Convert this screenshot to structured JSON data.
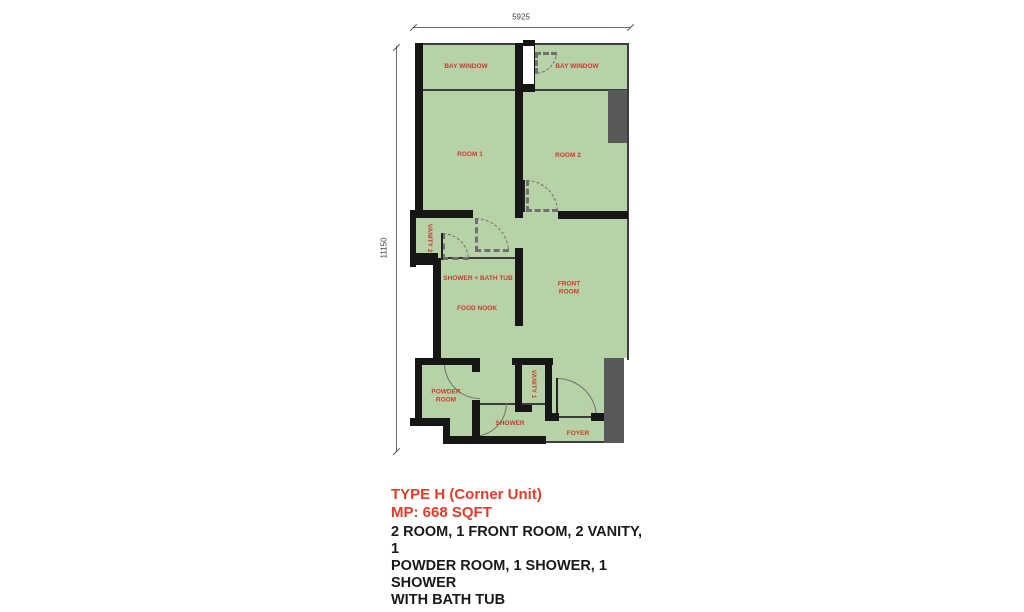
{
  "plan": {
    "dimensions": {
      "width_label": "5925",
      "height_label": "11150"
    },
    "rooms": [
      {
        "name": "bay-window-left",
        "label": "BAY WINDOW"
      },
      {
        "name": "bay-window-right",
        "label": "BAY WINDOW"
      },
      {
        "name": "room-1",
        "label": "ROOM 1"
      },
      {
        "name": "room-2",
        "label": "ROOM 2"
      },
      {
        "name": "vanity-2",
        "label": "VANITY 2"
      },
      {
        "name": "shower-bath-tub",
        "label": "SHOWER + BATH TUB"
      },
      {
        "name": "food-nook",
        "label": "FOOD NOOK"
      },
      {
        "name": "front-room",
        "label": "FRONT ROOM"
      },
      {
        "name": "powder-room",
        "label": "POWDER ROOM"
      },
      {
        "name": "vanity-1",
        "label": "VANITY 1"
      },
      {
        "name": "shower",
        "label": "SHOWER"
      },
      {
        "name": "foyer",
        "label": "FOYER"
      }
    ]
  },
  "caption": {
    "title": "TYPE H (Corner Unit)",
    "area": "MP: 668 SQFT",
    "description_lines": [
      "2 ROOM, 1 FRONT ROOM, 2 VANITY, 1",
      "POWDER ROOM, 1 SHOWER, 1 SHOWER",
      "WITH BATH TUB"
    ]
  },
  "colors": {
    "floor": "#b8d2a7",
    "wall": "#161616",
    "room_label": "#c63d2f",
    "shaft": "#58595b",
    "caption_title": "#e63b2a",
    "caption_text": "#1a1a1a",
    "dimension_text": "#3f3f3f"
  }
}
